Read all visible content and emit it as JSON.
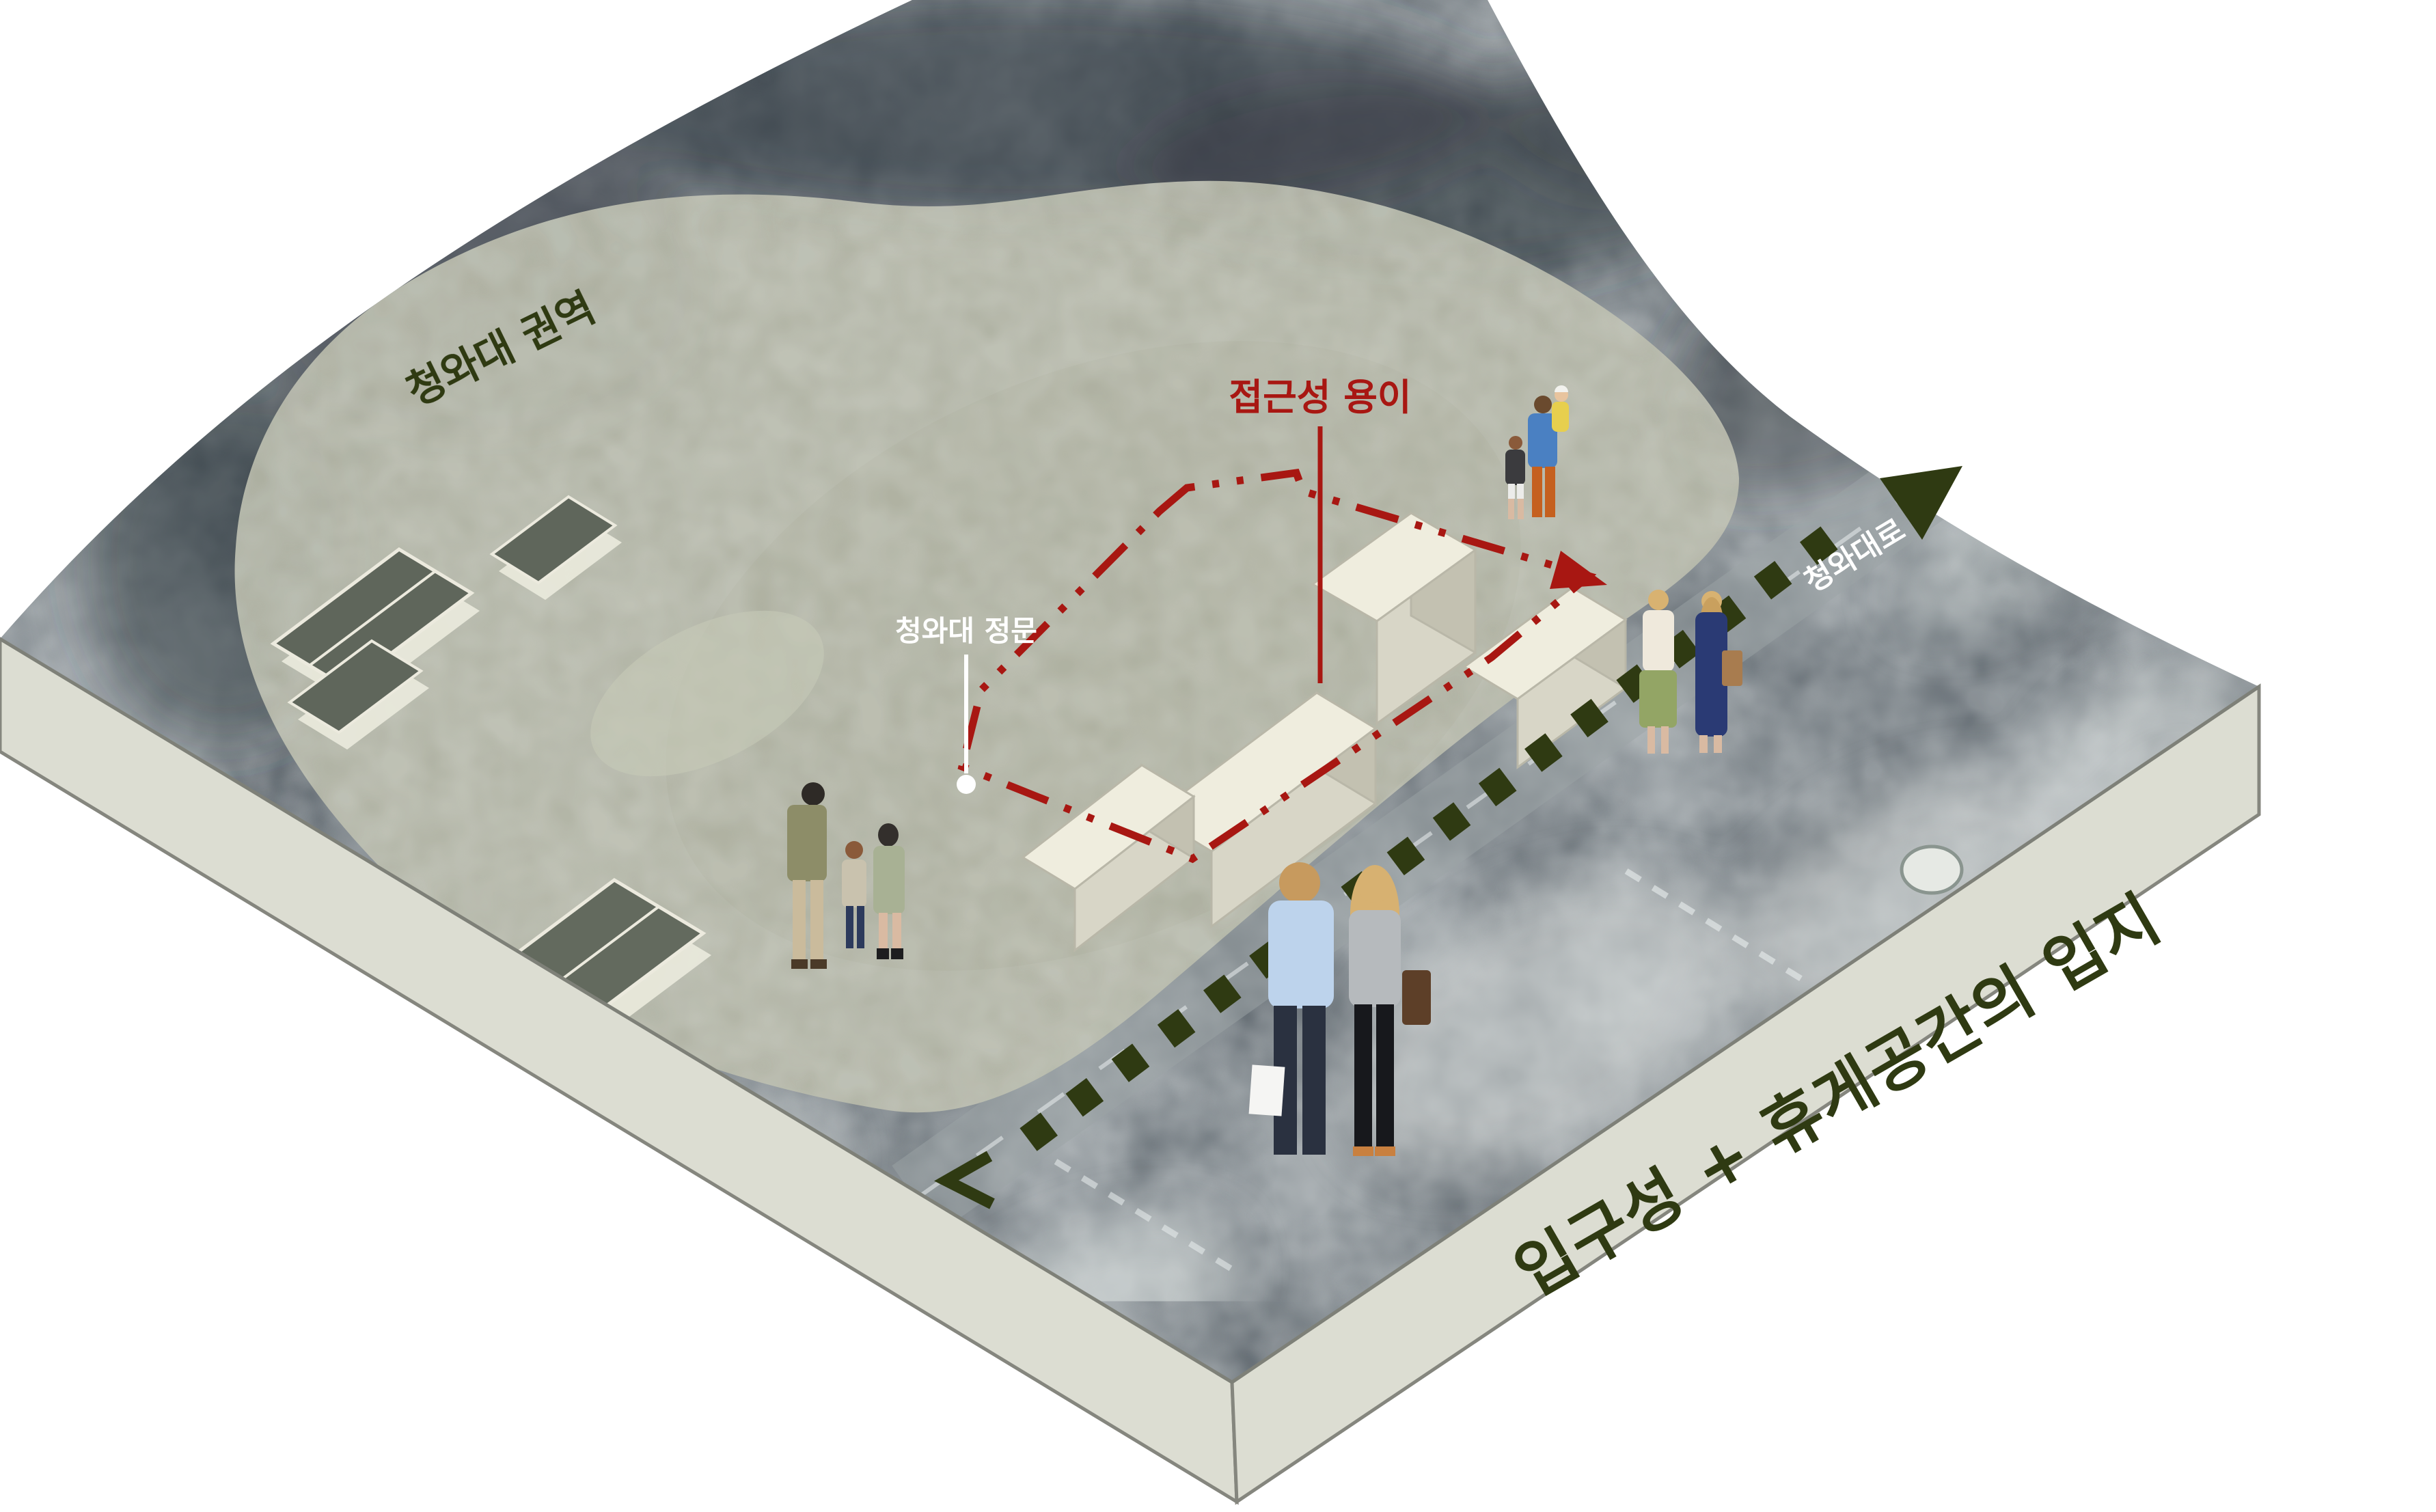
{
  "diagram": {
    "caption": "입구성 + 휴게공간의 입지",
    "zone_label": "청와대 권역",
    "accessibility_label": "접근성 용이",
    "gate_label": "청와대 정문",
    "road_label": "청와대로"
  },
  "colors": {
    "accent_red": "#a81712",
    "olive_dark": "#2f3a12",
    "zone_fill": "#b6b8a8",
    "slab_face": "#dcddd2",
    "slab_edge": "#85867e",
    "map_base": "#49525a",
    "label_white": "#ffffff"
  },
  "people": [
    {
      "id": "family-viewing",
      "desc": "family of three looking over the site"
    },
    {
      "id": "couple-shopping",
      "desc": "couple from behind with shopping bags"
    },
    {
      "id": "two-women-walking",
      "desc": "two women walking along the road"
    },
    {
      "id": "father-carrying-child",
      "desc": "father carrying child with a boy"
    }
  ]
}
